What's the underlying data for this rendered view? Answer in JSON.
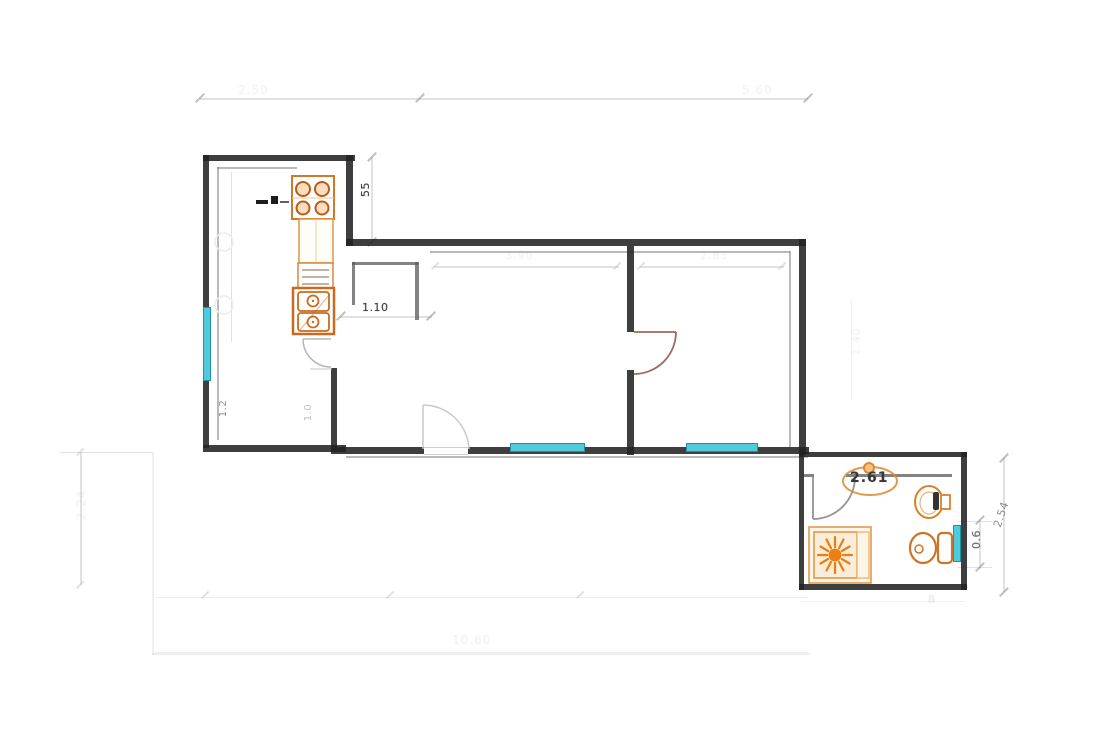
{
  "meta": {
    "type": "architectural-floor-plan",
    "description": "apartment floor plan with kitchen, living room, bedroom and bathroom"
  },
  "colors": {
    "wall": "#232323",
    "window": "#4fcbdb",
    "fixture_orange": "#cf7426",
    "door_arc": "#b5b5b5",
    "bedroom_door": "#a06a60",
    "dim_line": "#c8c8c8",
    "dim_text_dark": "#3d3d3d",
    "dim_text_light": "#8f8f8f"
  },
  "dims": {
    "kitchen_offset": {
      "text": "55"
    },
    "hall_width": {
      "text": "1.10"
    },
    "bath_width": {
      "text": "2.61"
    },
    "bath_window": {
      "text": "0.6"
    },
    "bath_depth": {
      "text": "2.54"
    },
    "kitchen_a": {
      "text": "1.2"
    },
    "kitchen_b": {
      "text": "1.0"
    },
    "top_left_faint": {
      "text": "2.50"
    },
    "top_right_faint": {
      "text": "5.60"
    },
    "left_faint": {
      "text": "2.24"
    },
    "living_faint": {
      "text": "3.90"
    },
    "bedroom_faint": {
      "text": "2.85"
    },
    "bottom_faint": {
      "text": "10.60"
    },
    "bedroom_right_faint": {
      "text": "1.40"
    },
    "bath_bottom_faint": {
      "text": "8"
    }
  },
  "fixtures": {
    "stove": "stove-4-burner",
    "kitchen_drawers": "drawer-cabinet",
    "kitchen_sink": "double-basin-sink",
    "faucet": "kitchen-faucet",
    "shower": "shower-tray-sunburst",
    "toilet": "toilet",
    "washbasin": "wash-basin",
    "basin_oval": "oval-basin"
  },
  "openings": {
    "doors": [
      "kitchen-door",
      "entry-door",
      "bedroom-door",
      "bathroom-door"
    ],
    "windows": [
      "kitchen-window",
      "living-room-window",
      "bedroom-window",
      "bathroom-window"
    ]
  }
}
